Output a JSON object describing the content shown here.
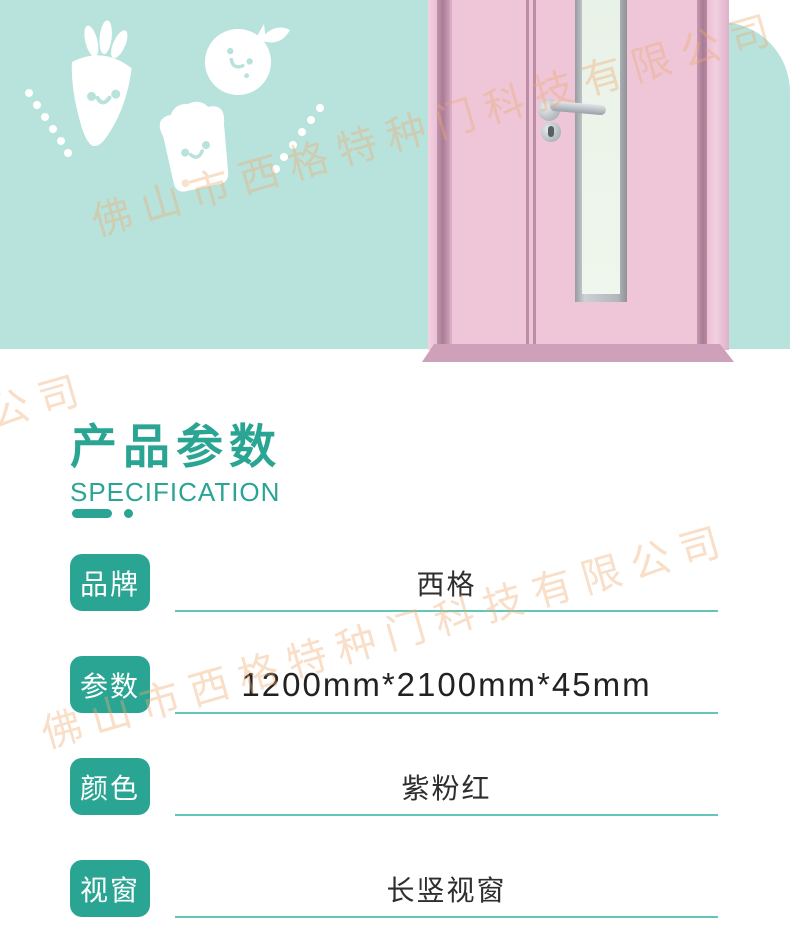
{
  "page": {
    "title": "产品参数",
    "subtitle": "SPECIFICATION"
  },
  "watermark": {
    "company": "佛山市西格特种门科技有限公司",
    "fragment": "限公司"
  },
  "spec": {
    "rows": [
      {
        "label": "品牌",
        "value": "西格"
      },
      {
        "label": "参数",
        "value": "1200mm*2100mm*45mm"
      },
      {
        "label": "颜色",
        "value": "紫粉红"
      },
      {
        "label": "视窗",
        "value": "长竖视窗"
      }
    ]
  },
  "illustrations": {
    "icons": [
      "carrot-icon",
      "tomato-icon",
      "toast-icon",
      "door-illustration",
      "door-handle-icon",
      "keyhole-icon"
    ]
  },
  "colors": {
    "banner_teal": "#b7e3dc",
    "accent_teal": "#2aa593",
    "underline_teal": "#63c6ba",
    "door_pink": "#eec6d8",
    "door_frame_pink": "#a87c94",
    "glass_green": "#e9f2e8",
    "watermark_orange": "#f0aa70",
    "value_text": "#2e2e2e"
  }
}
